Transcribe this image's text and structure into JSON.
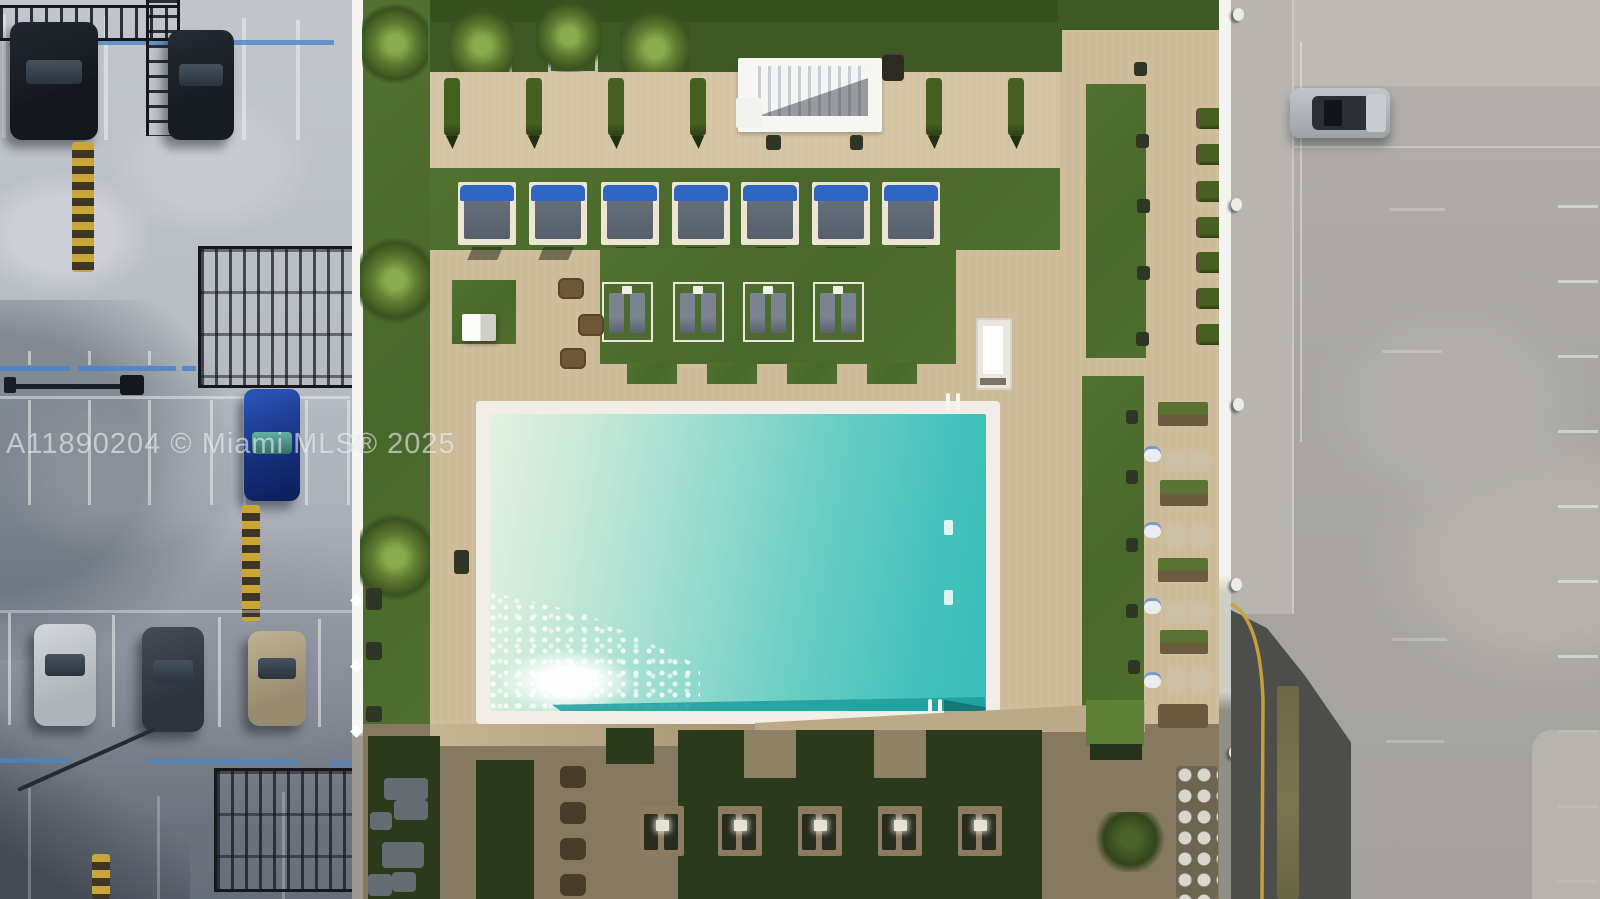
{
  "meta": {
    "title": "Aerial drone view of a condominium rooftop pool deck flanked by a parking garage roof and a surface parking lot",
    "image_type": "aerial-photo"
  },
  "watermark": {
    "text": "A11890204 © Miami MLS® 2025",
    "color": "rgba(255,255,255,0.55)"
  },
  "palette": {
    "turf_green": "#4c6b2e",
    "turf_dark": "#2c3a1c",
    "paver_tan": "#cdbb99",
    "paver_shadow": "#87795f",
    "pool_shallow": "#e4f1e2",
    "pool_deep": "#3cbdb8",
    "pool_shelf": "#1d9c9c",
    "concrete_garage": "#b6bcc2",
    "asphalt_street": "#a8a7a3",
    "asphalt_dark": "#4d4d49",
    "curb_yellow": "#c9a43c",
    "cabana_blue": "#2f66c4",
    "white_trim": "#f2f1ec",
    "accessible_blue": "#4a85c8"
  },
  "scene": {
    "regions": [
      "parking-garage-roof",
      "amenity-pool-deck",
      "street-parking-lot"
    ],
    "counts": {
      "cabanas": 7,
      "upper_lounger_pads": 4,
      "lower_lounger_pads": 5,
      "walkway_hedges": 6,
      "edge_hedge_squares": 7,
      "side_planter_boxes": 4,
      "garage_parked_cars": 6,
      "street_parked_cars": 1,
      "speed_bumps": 3,
      "pool_ladders": 2
    }
  }
}
